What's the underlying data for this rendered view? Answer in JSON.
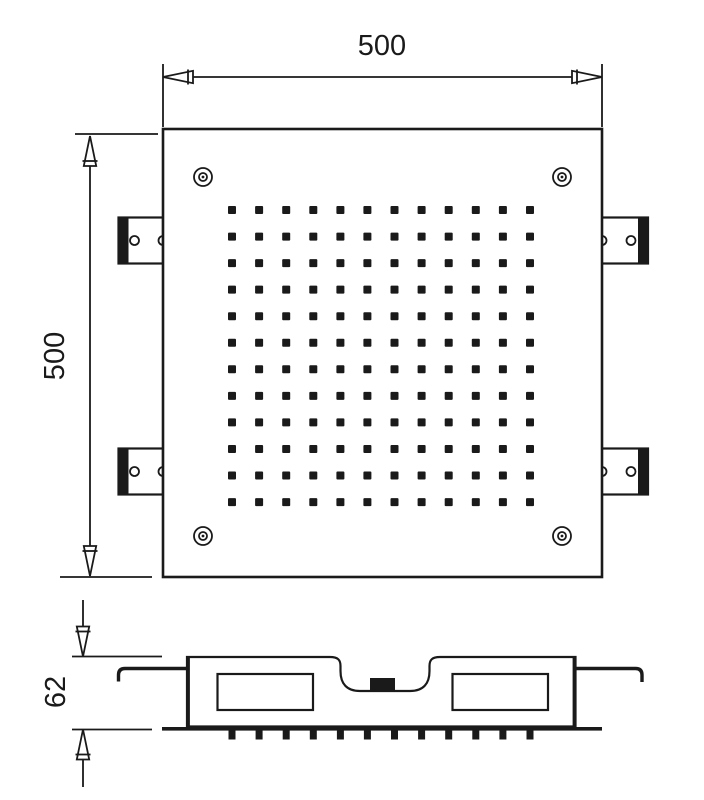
{
  "drawing": {
    "kind": "shower-head-dimension-drawing",
    "colors": {
      "line": "#1a1a1a",
      "background": "#ffffff"
    },
    "dims": {
      "width_label": "500",
      "height_label": "500",
      "depth_label": "62"
    },
    "top_view": {
      "nozzle_rows": 12,
      "nozzle_cols": 12,
      "corner_screw_count": 4,
      "mounting_bracket_count": 4
    },
    "side_view": {
      "nozzle_teeth_count": 12,
      "inner_chamber_count": 2,
      "inlet_connector_count": 1
    }
  }
}
